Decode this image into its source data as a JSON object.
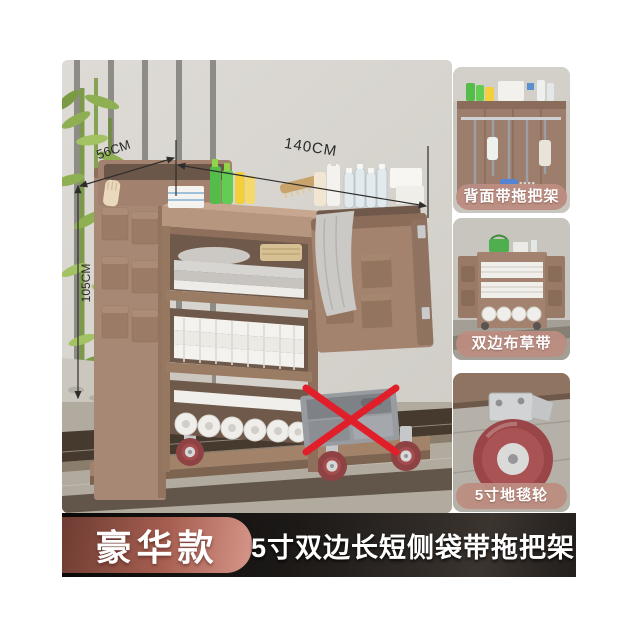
{
  "main": {
    "dimensions": {
      "width": "140CM",
      "depth": "56CM",
      "height": "105CM"
    },
    "overlays": {
      "prohibited_mark": "red-x"
    }
  },
  "insets": [
    {
      "caption": "背面带拖把架"
    },
    {
      "caption": "双边布草带"
    },
    {
      "caption": "5寸地毯轮"
    }
  ],
  "banner": {
    "badge": "豪华款",
    "title": "5寸双边长短侧袋带拖把架"
  },
  "colors": {
    "cart_body": "#a78874",
    "cart_dark": "#8d6f5c",
    "badge_gradient_start": "#6e3c32",
    "badge_gradient_end": "#d6978a",
    "banner_bg": "#1c1917",
    "caption_bg": "#bd8d81",
    "wheel_rim": "#8e4244",
    "prohibited_x": "#e01f2a",
    "wall": "#d9d6d1",
    "floor": "#b1aa9e"
  }
}
